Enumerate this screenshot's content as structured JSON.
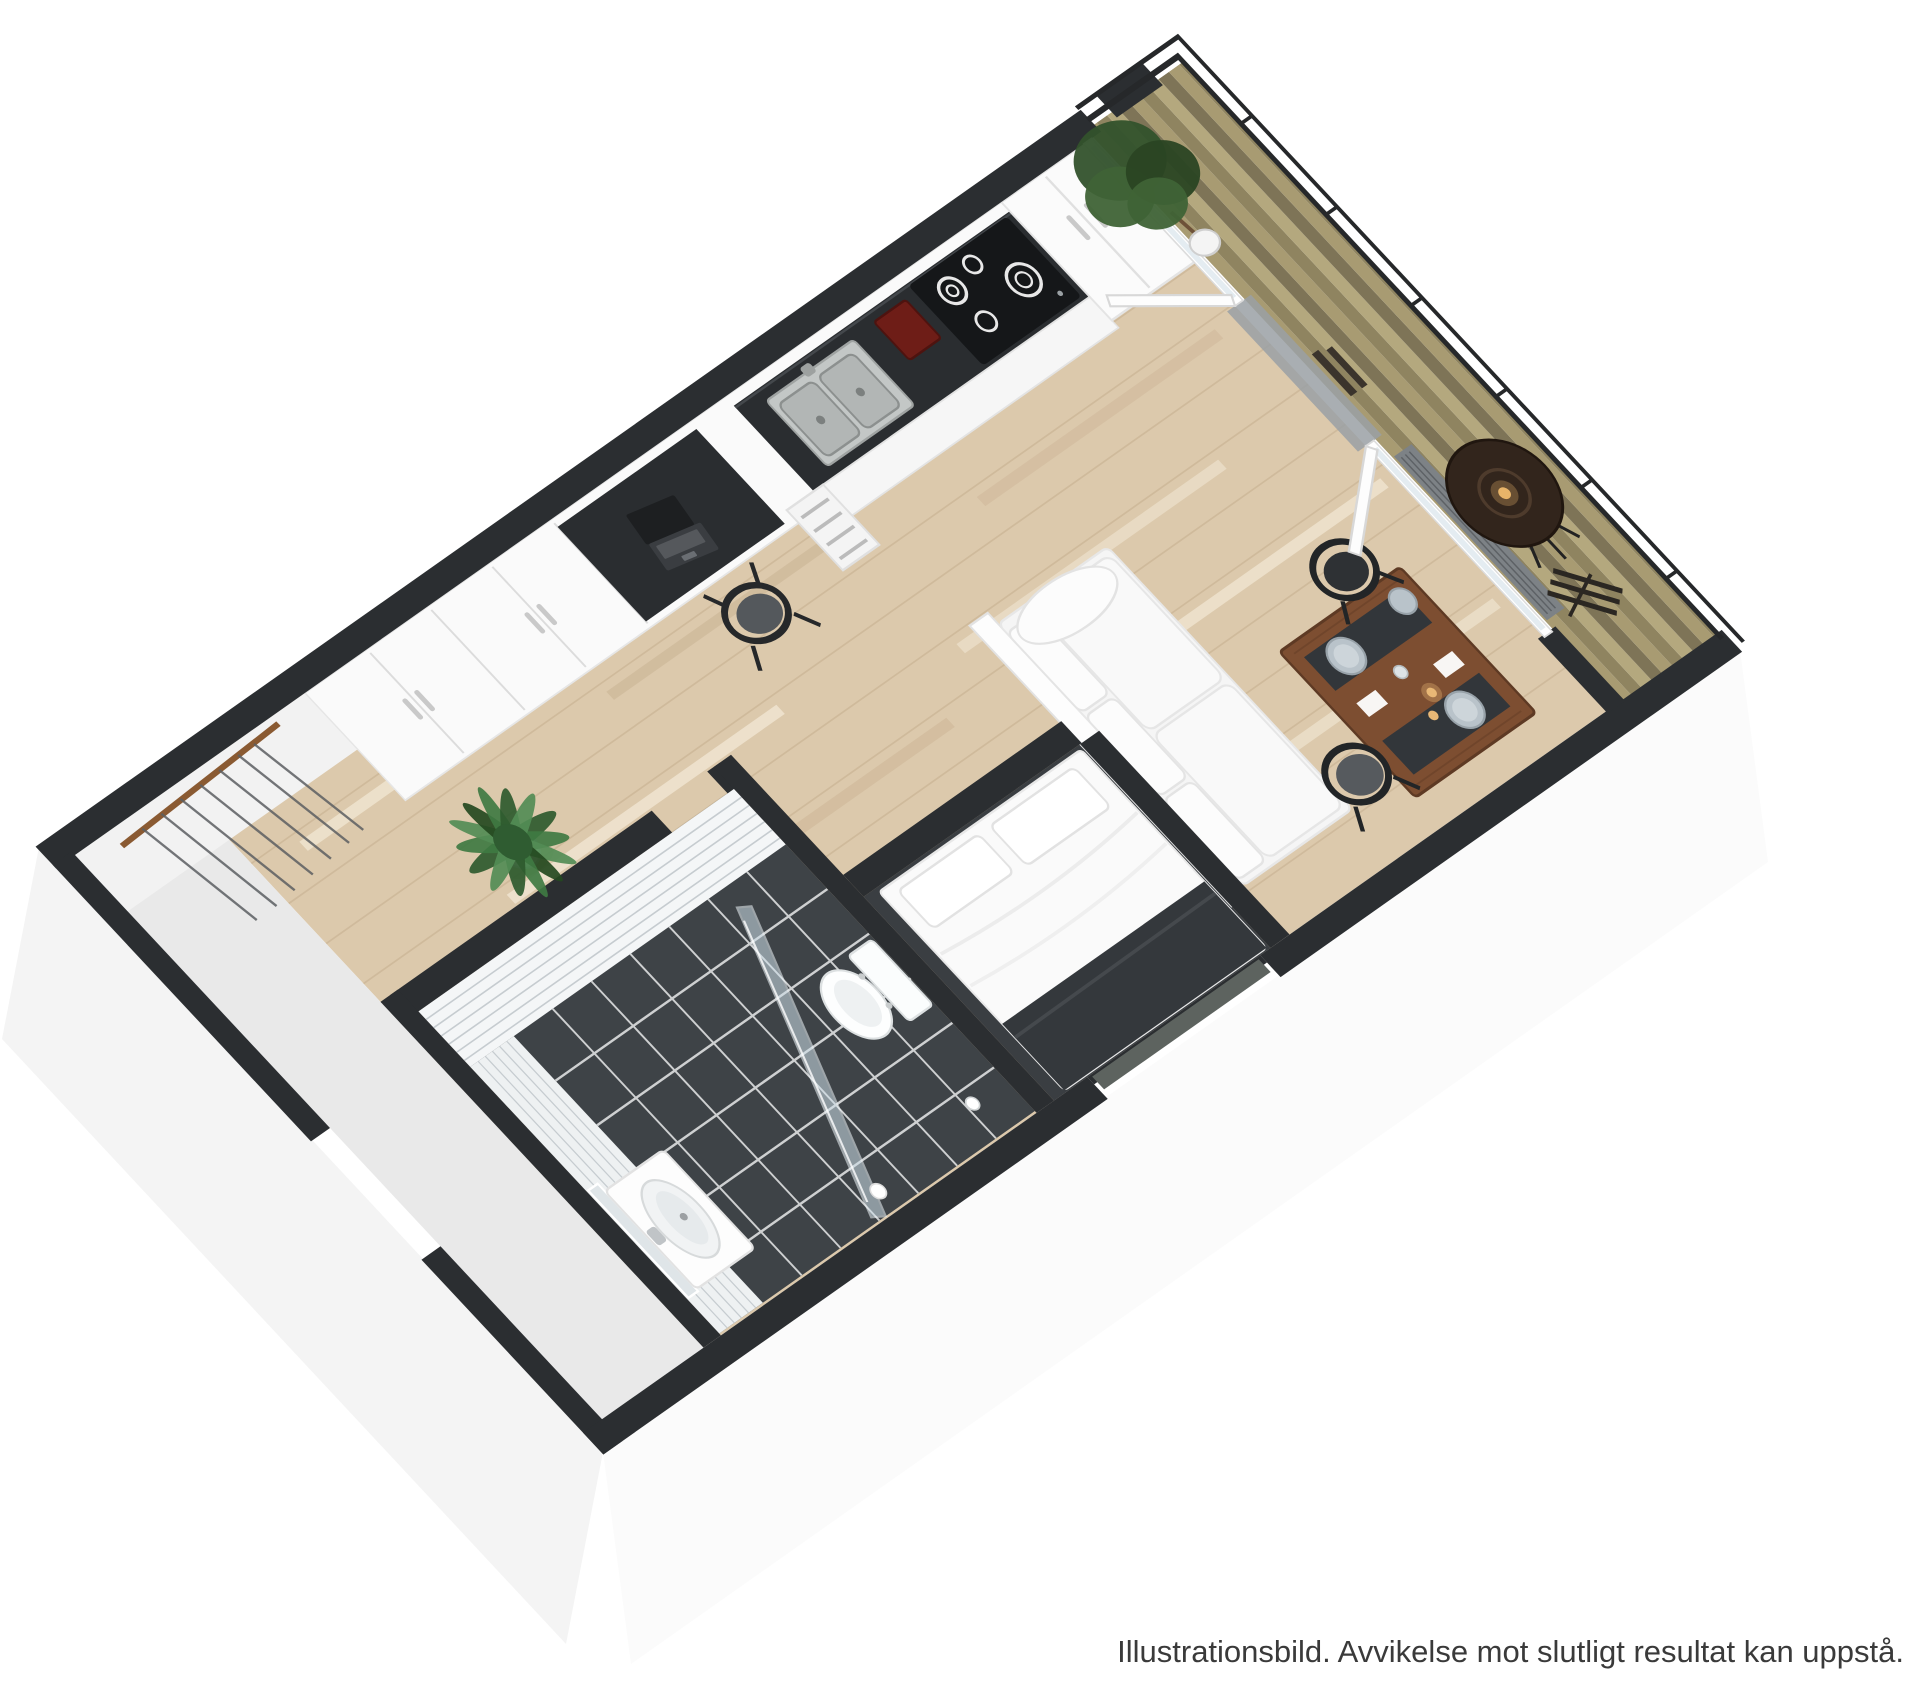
{
  "caption": {
    "text": "Illustrationsbild. Avvikelse mot slutligt resultat kan uppstå."
  },
  "scene": {
    "type": "3d-floor-plan-rendering",
    "rooms": [
      "hall",
      "bathroom",
      "sleeping-alcove",
      "kitchen",
      "living-dining",
      "balcony"
    ],
    "furniture": [
      "coat-rack",
      "potted-palm",
      "wardrobes",
      "desk-with-laptop",
      "desk-chair",
      "kitchen-counter-with-sink",
      "coffee-machine",
      "cooktop",
      "fridge-freezer",
      "drawer-unit",
      "sofa",
      "bed",
      "dining-table",
      "dining-chairs",
      "washbasin-with-mirror",
      "toilet",
      "shower-screen",
      "balcony-tree",
      "bistro-table",
      "folding-chair",
      "radiator",
      "balcony-railing"
    ],
    "colors": {
      "background": "#ffffff",
      "wall_cap": "#2b2e31",
      "wood_floor": "#dcc9ac",
      "bathroom_floor": "#3e4347",
      "tile_wall": "#f4f6f7",
      "counter": "#2a2d30",
      "deck": "#a1956c",
      "dining_table_wood": "#7d4e31",
      "plant_green": "#3f7a42",
      "appliance_red": "#6e1d17",
      "caption_text": "#3a3a3a"
    }
  }
}
